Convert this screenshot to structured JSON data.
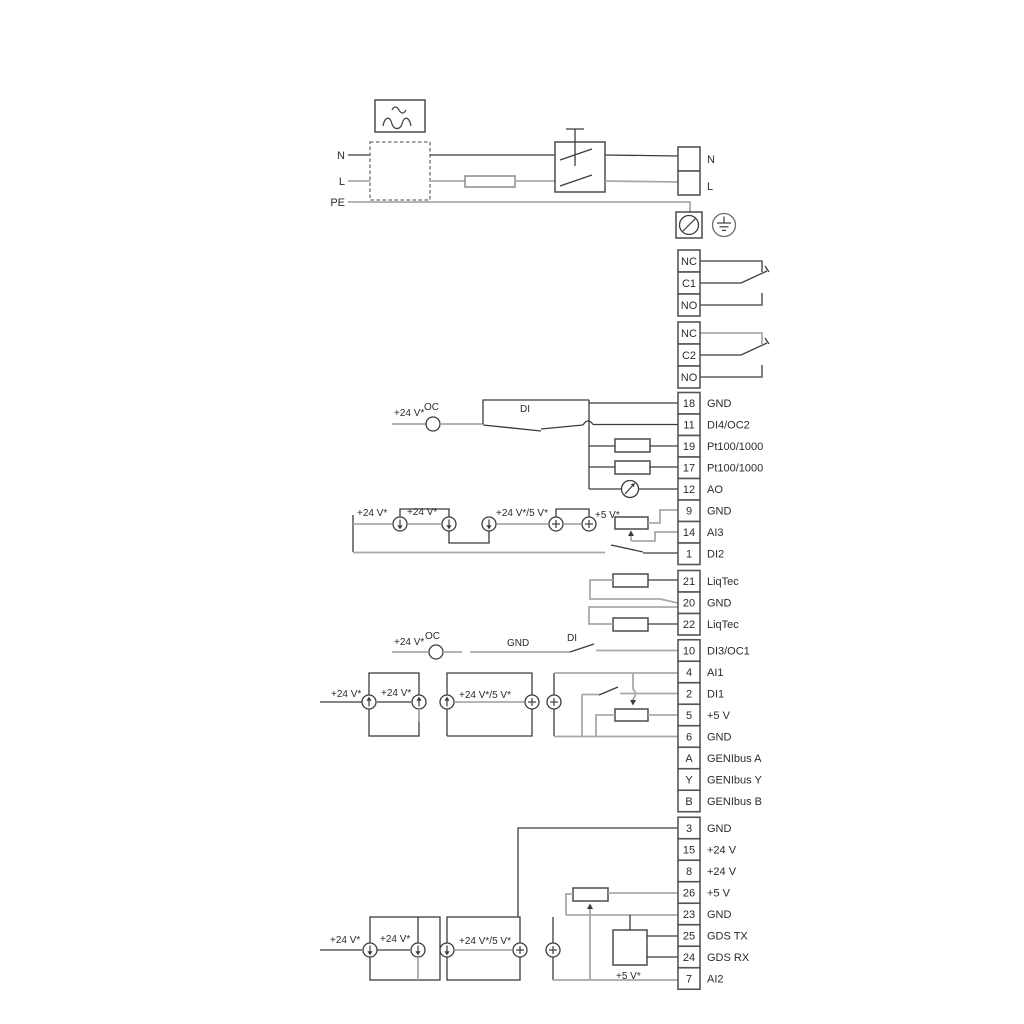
{
  "power": {
    "n_left": "N",
    "l_left": "L",
    "pe": "PE",
    "n_right": "N",
    "l_right": "L"
  },
  "labels": {
    "plus24": "+24 V*",
    "plus24_5": "+24 V*/5 V*",
    "plus5": "+5 V*",
    "oc": "OC",
    "di": "DI",
    "gnd": "GND"
  },
  "relays": [
    {
      "rows": [
        {
          "no": "NC"
        },
        {
          "no": "C1"
        },
        {
          "no": "NO"
        }
      ]
    },
    {
      "rows": [
        {
          "no": "NC"
        },
        {
          "no": "C2"
        },
        {
          "no": "NO"
        }
      ]
    }
  ],
  "terminals": {
    "io1": [
      {
        "no": "18",
        "label": "GND"
      },
      {
        "no": "11",
        "label": "DI4/OC2"
      },
      {
        "no": "19",
        "label": "Pt100/1000"
      },
      {
        "no": "17",
        "label": "Pt100/1000"
      },
      {
        "no": "12",
        "label": "AO"
      },
      {
        "no": "9",
        "label": "GND"
      },
      {
        "no": "14",
        "label": "AI3"
      },
      {
        "no": "1",
        "label": "DI2"
      }
    ],
    "liqtec": [
      {
        "no": "21",
        "label": "LiqTec"
      },
      {
        "no": "20",
        "label": "GND"
      },
      {
        "no": "22",
        "label": "LiqTec"
      }
    ],
    "io2": [
      {
        "no": "10",
        "label": "DI3/OC1"
      },
      {
        "no": "4",
        "label": "AI1"
      },
      {
        "no": "2",
        "label": "DI1"
      },
      {
        "no": "5",
        "label": "+5 V"
      },
      {
        "no": "6",
        "label": "GND"
      },
      {
        "no": "A",
        "label": "GENIbus A"
      },
      {
        "no": "Y",
        "label": "GENIbus Y"
      },
      {
        "no": "B",
        "label": "GENIbus B"
      }
    ],
    "io3": [
      {
        "no": "3",
        "label": "GND"
      },
      {
        "no": "15",
        "label": "+24 V"
      },
      {
        "no": "8",
        "label": "+24 V"
      },
      {
        "no": "26",
        "label": "+5 V"
      },
      {
        "no": "23",
        "label": "GND"
      },
      {
        "no": "25",
        "label": "GDS TX"
      },
      {
        "no": "24",
        "label": "GDS RX"
      },
      {
        "no": "7",
        "label": "AI2"
      }
    ]
  },
  "colors": {
    "line_dark": "#3c3c3e",
    "line_gray": "#a7a9ac",
    "text": "#2b2b2d"
  }
}
